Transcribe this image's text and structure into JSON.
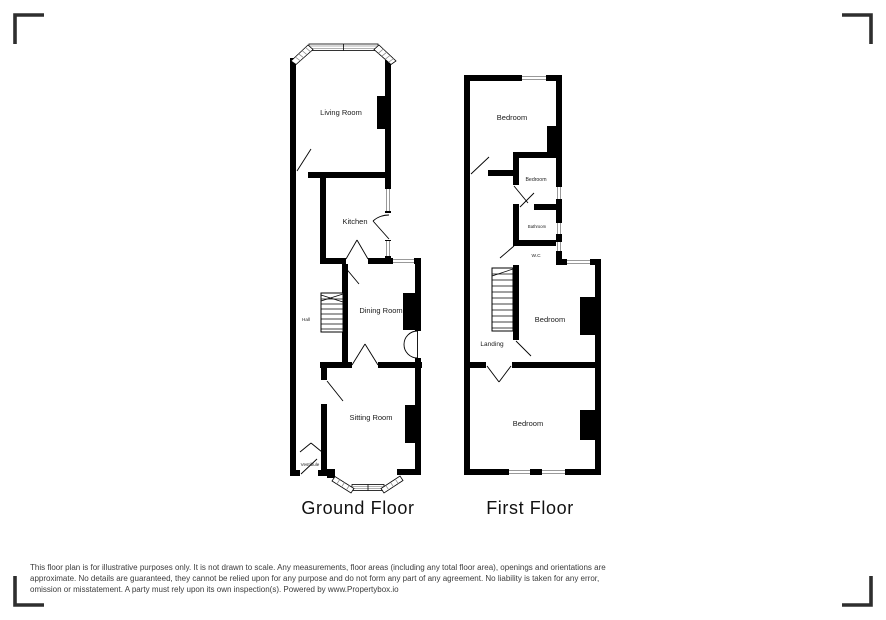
{
  "floors": [
    {
      "title": "Ground Floor",
      "rooms": [
        {
          "label": "Living Room"
        },
        {
          "label": "Kitchen"
        },
        {
          "label": "Hall"
        },
        {
          "label": "Dining Room"
        },
        {
          "label": "Sitting Room"
        },
        {
          "label": "Vestibule"
        }
      ]
    },
    {
      "title": "First Floor",
      "rooms": [
        {
          "label": "Bedroom"
        },
        {
          "label": "Bedroom"
        },
        {
          "label": "Bathroom"
        },
        {
          "label": "W.C"
        },
        {
          "label": "Bedroom"
        },
        {
          "label": "Landing"
        },
        {
          "label": "Bedroom"
        }
      ]
    }
  ],
  "disclaimer": "This floor plan is for illustrative purposes only. It is not drawn to scale. Any measurements, floor areas (including any total floor area), openings and orientations are approximate. No details are guaranteed, they cannot be relied upon for any purpose and do not form any part of any agreement. No liability is taken for any error, omission or misstatement. A party must rely upon its own inspection(s). Powered by www.Propertybox.io",
  "colors": {
    "wall": "#000000",
    "window_line": "#999999",
    "corner_bracket": "#2e2e2e",
    "text": "#1a1a1a"
  }
}
